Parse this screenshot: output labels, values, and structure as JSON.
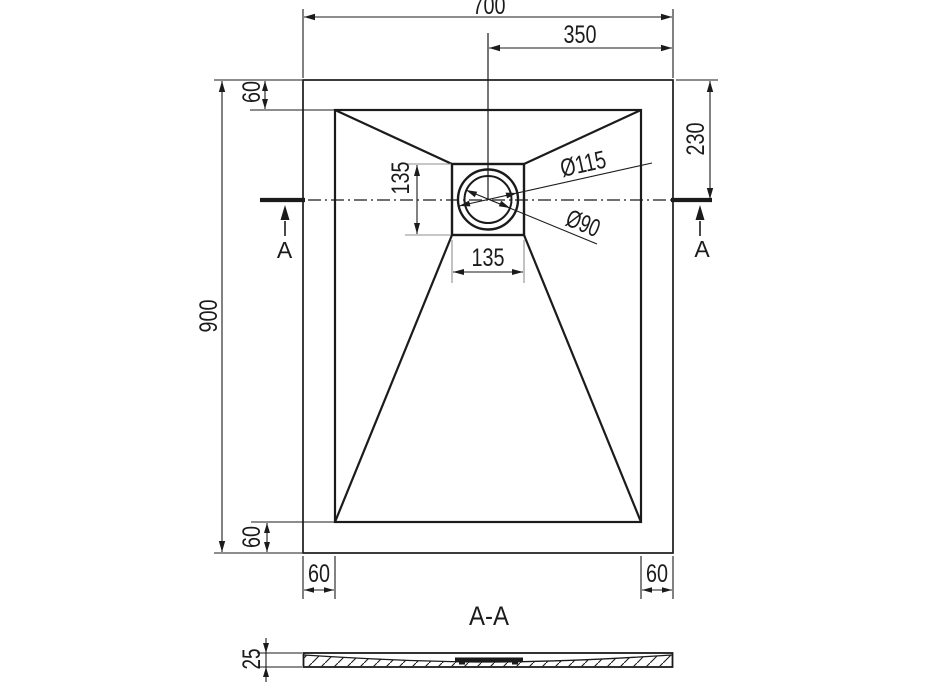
{
  "drawing": {
    "labels": {
      "width": "700",
      "half_width": "350",
      "height": "900",
      "drain_offset_top": "230",
      "edge_top": "60",
      "edge_bottom": "60",
      "edge_left": "60",
      "edge_right": "60",
      "drain_width": "135",
      "drain_height": "135",
      "drain_outer_diameter": "Ø115",
      "drain_inner_diameter": "Ø90",
      "thickness": "25",
      "section_title": "A-A",
      "section_marker_left": "A",
      "section_marker_right": "A"
    },
    "colors": {
      "line": "#1b1b1b",
      "extension_line": "#8f8f8f",
      "background": "#ffffff"
    }
  }
}
